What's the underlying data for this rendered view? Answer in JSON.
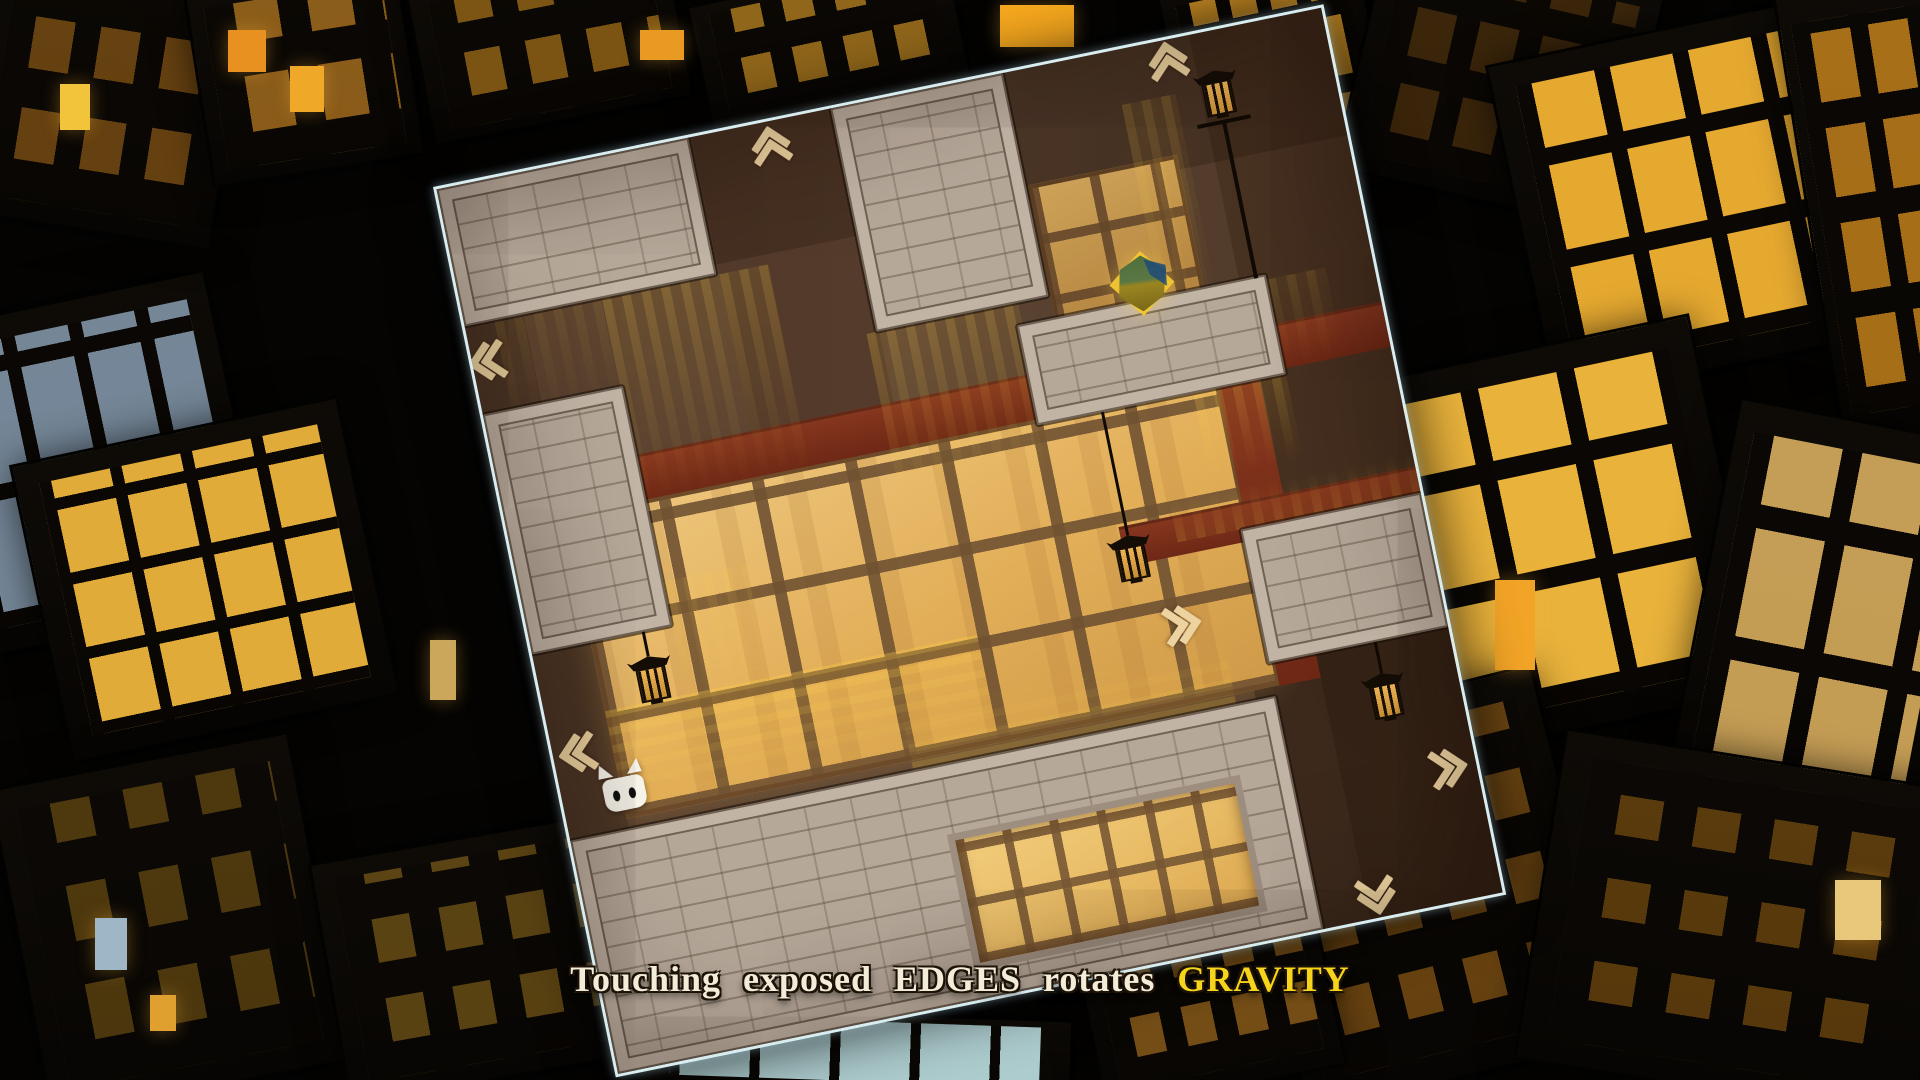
{
  "banner": {
    "segments": [
      {
        "text": "Touching exposed ",
        "color": "#f3ecd9"
      },
      {
        "text": "EDGES",
        "color": "#f3ecd9"
      },
      {
        "text": " rotates ",
        "color": "#f3ecd9"
      },
      {
        "text": "GRAVITY",
        "color": "#f5d41b"
      }
    ]
  },
  "colors": {
    "accent_yellow": "#f5d41b",
    "text_cream": "#f3ecd9",
    "board_edge": "#d9edf1",
    "brick": "#b6a899",
    "window_amber": "#e2ae58",
    "beam_red": "#7e2f1c",
    "chevron": "#ecd3a0"
  },
  "board": {
    "origin_x": 433,
    "origin_y": 187,
    "size": 903,
    "rotation_deg": -11.6,
    "shades": [
      {
        "x": 0,
        "y": 0,
        "w": 903,
        "h": 130,
        "c": "rgba(28,14,7,0.25)"
      },
      {
        "x": 0,
        "y": 0,
        "w": 60,
        "h": 903,
        "c": "rgba(28,14,7,0.2)"
      },
      {
        "x": 768,
        "y": 0,
        "w": 135,
        "h": 903,
        "c": "rgba(38,19,9,0.25)"
      },
      {
        "x": 700,
        "y": 620,
        "w": 203,
        "h": 283,
        "c": "rgba(22,11,5,0.35)"
      },
      {
        "x": 260,
        "y": 0,
        "w": 145,
        "h": 300,
        "c": "rgba(48,22,12,0.18)"
      }
    ],
    "windows_back": [
      {
        "x": 60,
        "y": 345,
        "w": 668,
        "h": 310,
        "tone": "bright"
      },
      {
        "x": 580,
        "y": 115,
        "w": 152,
        "h": 185,
        "tone": "dim"
      }
    ],
    "beams": [
      {
        "x": 0,
        "y": 300,
        "w": 903,
        "h": 46
      },
      {
        "x": 726,
        "y": 300,
        "w": 42,
        "h": 356
      },
      {
        "x": 600,
        "y": 468,
        "w": 303,
        "h": 40
      }
    ],
    "glows": [
      {
        "x": 140,
        "y": 140,
        "w": 170,
        "h": 230,
        "o": 0.3,
        "dir": "down",
        "kind": "v"
      },
      {
        "x": 30,
        "y": 140,
        "w": 110,
        "h": 120,
        "o": 0.14,
        "dir": "down",
        "kind": "v"
      },
      {
        "x": 392,
        "y": 228,
        "w": 155,
        "h": 195,
        "o": 0.3,
        "dir": "down",
        "kind": "v"
      },
      {
        "x": 688,
        "y": 55,
        "w": 55,
        "h": 245,
        "o": 0.22,
        "dir": "down",
        "kind": "v"
      },
      {
        "x": 700,
        "y": 352,
        "w": 95,
        "h": 95,
        "o": 0.28,
        "dir": "down",
        "kind": "v"
      },
      {
        "x": 655,
        "y": 450,
        "w": 250,
        "h": 45,
        "o": 0.22,
        "dir": "up",
        "kind": "v"
      },
      {
        "x": 350,
        "y": 598,
        "w": 330,
        "h": 67,
        "o": 0.3,
        "dir": "up",
        "kind": "h"
      },
      {
        "x": 60,
        "y": 545,
        "w": 380,
        "h": 115,
        "o": 0.42,
        "dir": "down",
        "kind": "h"
      },
      {
        "x": 143,
        "y": 430,
        "w": 85,
        "h": 160,
        "o": 0.18,
        "dir": "down",
        "kind": "v"
      },
      {
        "x": 795,
        "y": 255,
        "w": 60,
        "h": 100,
        "o": 0.18,
        "dir": "down",
        "kind": "v"
      }
    ],
    "platforms": [
      {
        "x": 0,
        "y": 0,
        "w": 257,
        "h": 140
      },
      {
        "x": 402,
        "y": 0,
        "w": 176,
        "h": 228
      },
      {
        "x": 541,
        "y": 250,
        "w": 254,
        "h": 102
      },
      {
        "x": 0,
        "y": 230,
        "w": 143,
        "h": 245
      },
      {
        "x": 719,
        "y": 495,
        "w": 184,
        "h": 137
      },
      {
        "x": 0,
        "y": 665,
        "w": 720,
        "h": 238
      }
    ],
    "windows_front": [
      {
        "x": 370,
        "y": 735,
        "w": 285,
        "h": 125,
        "tone": "inset"
      }
    ],
    "chevrons": [
      {
        "dir": "up",
        "x": 333,
        "y": 27
      },
      {
        "dir": "up",
        "x": 739,
        "y": 24
      },
      {
        "dir": "left",
        "x": 18,
        "y": 182
      },
      {
        "dir": "left",
        "x": 28,
        "y": 584
      },
      {
        "dir": "right",
        "x": 640,
        "y": 573
      },
      {
        "dir": "right",
        "x": 872,
        "y": 767
      },
      {
        "dir": "down",
        "x": 782,
        "y": 878
      }
    ],
    "lanterns": [
      {
        "type": "hang",
        "x": 113,
        "chain_top": 475,
        "head_top": 500
      },
      {
        "type": "hang",
        "x": 607,
        "chain_top": 352,
        "head_top": 478
      },
      {
        "type": "hang",
        "x": 828,
        "chain_top": 632,
        "head_top": 664
      },
      {
        "type": "pole",
        "x": 785,
        "head_top": 40,
        "pole_bottom": 252
      }
    ],
    "cat": {
      "cx": 63,
      "bottom": 648
    },
    "gem": {
      "cx": 672,
      "cy": 234
    }
  },
  "city": {
    "buildings": [
      {
        "x": -60,
        "y": 300,
        "w": 300,
        "h": 330,
        "rot": -12,
        "lit": "#8fa6bc",
        "alpha": 0.8,
        "pw": 54,
        "ph": 110,
        "mw": 14,
        "mh": 16
      },
      {
        "x": 40,
        "y": 430,
        "w": 330,
        "h": 300,
        "rot": -12,
        "lit": "#edb43c",
        "alpha": 0.95,
        "pw": 60,
        "ph": 64,
        "mw": 12,
        "mh": 12
      },
      {
        "x": -20,
        "y": -30,
        "w": 250,
        "h": 260,
        "rot": 9,
        "lit": "#c07a1c",
        "alpha": 0.5,
        "pw": 40,
        "ph": 52,
        "mw": 26,
        "mh": 40
      },
      {
        "x": 200,
        "y": -20,
        "w": 210,
        "h": 190,
        "rot": -9,
        "lit": "#e09428",
        "alpha": 0.6,
        "pw": 44,
        "ph": 56,
        "mw": 30,
        "mh": 34
      },
      {
        "x": 420,
        "y": -30,
        "w": 260,
        "h": 150,
        "rot": -11,
        "lit": "#d8921f",
        "alpha": 0.55,
        "pw": 36,
        "ph": 44,
        "mw": 26,
        "mh": 30
      },
      {
        "x": 700,
        "y": -20,
        "w": 260,
        "h": 130,
        "rot": -12,
        "lit": "#e8a428",
        "alpha": 0.6,
        "pw": 30,
        "ph": 36,
        "mw": 22,
        "mh": 26
      },
      {
        "x": 1180,
        "y": -30,
        "w": 200,
        "h": 230,
        "rot": -12,
        "lit": "#f0a82a",
        "alpha": 0.8,
        "pw": 26,
        "ph": 60,
        "mw": 14,
        "mh": 18
      },
      {
        "x": 1360,
        "y": -40,
        "w": 280,
        "h": 240,
        "rot": 13,
        "lit": "#6b4310",
        "alpha": 0.5,
        "pw": 40,
        "ph": 50,
        "mw": 24,
        "mh": 28
      },
      {
        "x": 1520,
        "y": 30,
        "w": 330,
        "h": 340,
        "rot": -12,
        "lit": "#f2b233",
        "alpha": 0.95,
        "pw": 64,
        "ph": 86,
        "mw": 16,
        "mh": 18
      },
      {
        "x": 1810,
        "y": -20,
        "w": 150,
        "h": 460,
        "rot": -9,
        "lit": "#e89a20",
        "alpha": 0.7,
        "pw": 40,
        "ph": 70,
        "mw": 18,
        "mh": 26
      },
      {
        "x": 1370,
        "y": 350,
        "w": 360,
        "h": 380,
        "rot": -12,
        "lit": "#f5bc3e",
        "alpha": 0.95,
        "pw": 80,
        "ph": 96,
        "mw": 18,
        "mh": 20
      },
      {
        "x": 1700,
        "y": 420,
        "w": 250,
        "h": 420,
        "rot": 11,
        "lit": "#e5b864",
        "alpha": 0.85,
        "pw": 70,
        "ph": 110,
        "mw": 20,
        "mh": 24
      },
      {
        "x": 1260,
        "y": 700,
        "w": 320,
        "h": 380,
        "rot": -14,
        "lit": "#d98a20",
        "alpha": 0.45,
        "pw": 36,
        "ph": 46,
        "mw": 30,
        "mh": 40
      },
      {
        "x": 1540,
        "y": 760,
        "w": 400,
        "h": 330,
        "rot": 9,
        "lit": "#cc8418",
        "alpha": 0.4,
        "pw": 44,
        "ph": 40,
        "mw": 34,
        "mh": 44
      },
      {
        "x": 20,
        "y": 760,
        "w": 300,
        "h": 330,
        "rot": -11,
        "lit": "#c8901f",
        "alpha": 0.35,
        "pw": 40,
        "ph": 56,
        "mw": 34,
        "mh": 44
      },
      {
        "x": 330,
        "y": 840,
        "w": 280,
        "h": 240,
        "rot": -10,
        "lit": "#d09a28",
        "alpha": 0.4,
        "pw": 38,
        "ph": 44,
        "mw": 30,
        "mh": 36
      },
      {
        "x": 640,
        "y": 1015,
        "w": 430,
        "h": 80,
        "rot": 2,
        "lit": "#bfe2e4",
        "alpha": 0.9,
        "pw": 70,
        "ph": 60,
        "mw": 10,
        "mh": 8
      },
      {
        "x": 1080,
        "y": 830,
        "w": 240,
        "h": 260,
        "rot": -12,
        "lit": "#e09428",
        "alpha": 0.5,
        "pw": 30,
        "ph": 40,
        "mw": 22,
        "mh": 30
      }
    ],
    "lights": [
      {
        "x": 60,
        "y": 84,
        "w": 30,
        "h": 46,
        "c": "#f2c43c"
      },
      {
        "x": 228,
        "y": 30,
        "w": 38,
        "h": 42,
        "c": "#e89020"
      },
      {
        "x": 290,
        "y": 66,
        "w": 34,
        "h": 46,
        "c": "#f0a828"
      },
      {
        "x": 640,
        "y": 30,
        "w": 44,
        "h": 30,
        "c": "#e89a22"
      },
      {
        "x": 1000,
        "y": 5,
        "w": 74,
        "h": 42,
        "c": "#f7a81e"
      },
      {
        "x": 95,
        "y": 918,
        "w": 32,
        "h": 52,
        "c": "#9fb6c6"
      },
      {
        "x": 150,
        "y": 995,
        "w": 26,
        "h": 36,
        "c": "#e0a030"
      },
      {
        "x": 1495,
        "y": 580,
        "w": 40,
        "h": 90,
        "c": "#f2a426"
      },
      {
        "x": 1835,
        "y": 880,
        "w": 46,
        "h": 60,
        "c": "#e8c87a"
      },
      {
        "x": 430,
        "y": 640,
        "w": 26,
        "h": 60,
        "c": "#caa75a"
      }
    ]
  }
}
